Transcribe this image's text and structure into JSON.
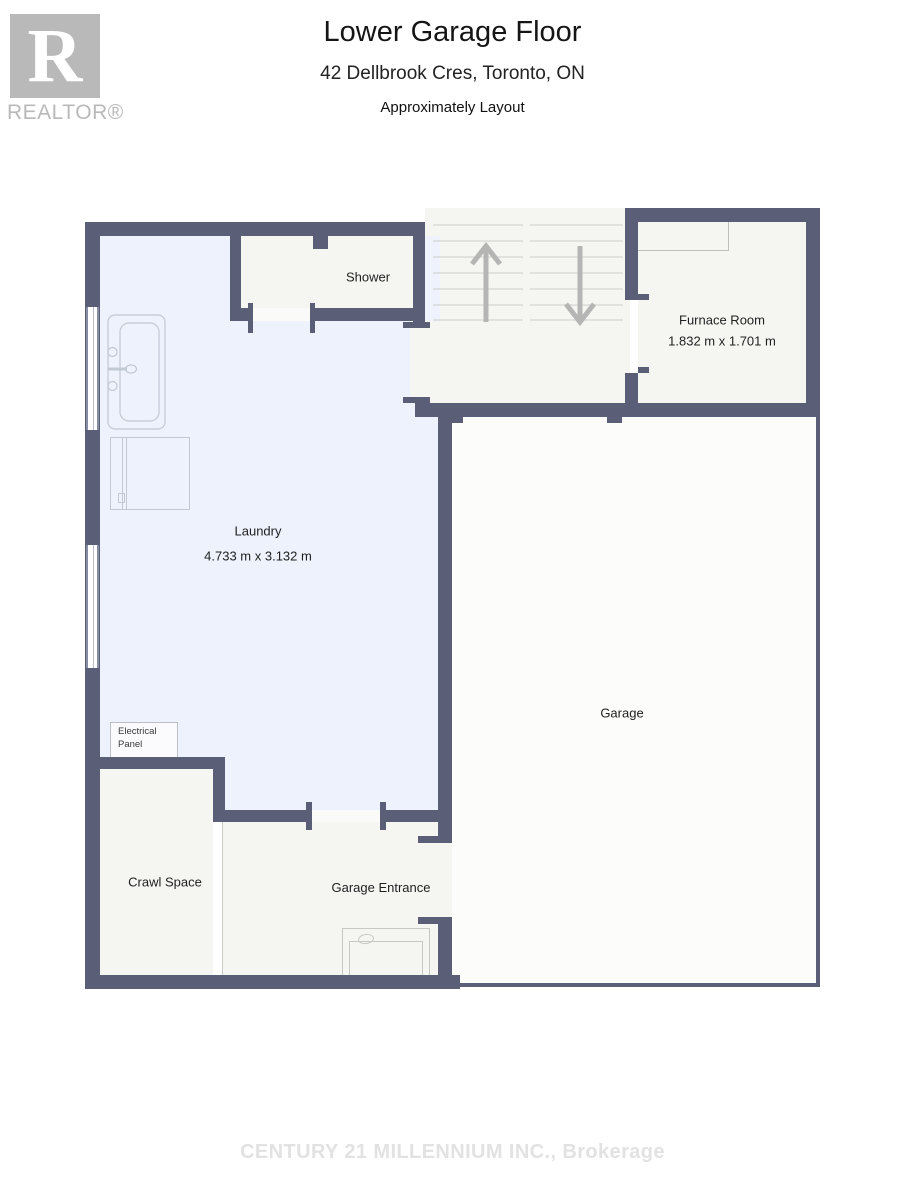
{
  "header": {
    "logo_letter": "R",
    "brand": "REALTOR®",
    "title": "Lower Garage Floor",
    "subtitle": "42 Dellbrook Cres, Toronto, ON",
    "note": "Approximately Layout"
  },
  "rooms": {
    "shower": {
      "label": "Shower"
    },
    "furnace": {
      "label": "Furnace Room",
      "dims": "1.832 m x 1.701 m"
    },
    "laundry": {
      "label": "Laundry",
      "dims": "4.733 m x 3.132 m"
    },
    "garage": {
      "label": "Garage"
    },
    "crawl": {
      "label": "Crawl Space"
    },
    "entrance": {
      "label": "Garage Entrance"
    },
    "electrical": {
      "label": "Electrical Panel"
    }
  },
  "stairs": {
    "up_icon": "stairs-up-arrow",
    "down_icon": "stairs-down-arrow"
  },
  "footer": {
    "watermark": "CENTURY 21 MILLENNIUM INC., Brokerage"
  },
  "colors": {
    "wall": "#5a5e76",
    "laundry_floor": "#edf2fc",
    "room_floor": "#f5f5f2",
    "garage_floor": "#fcfcfb",
    "fixture_line": "#c2c8d4",
    "tread_line": "#cdcdc8",
    "arrow": "#b5b5b3",
    "brand_gray": "#b9b9b9",
    "watermark_gray": "#e2e2e2"
  }
}
